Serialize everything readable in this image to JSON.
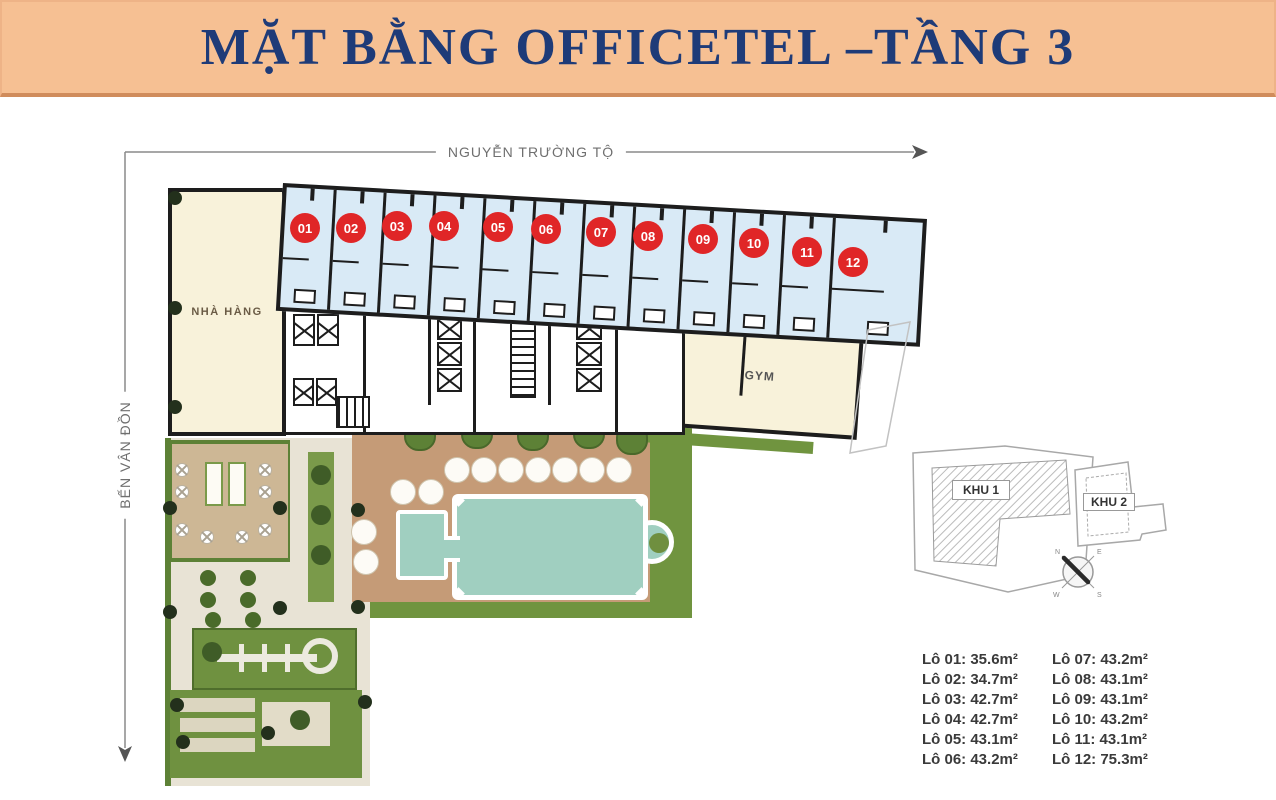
{
  "title": "MẶT BẰNG OFFICETEL –TẦNG 3",
  "streets": {
    "top": "NGUYỄN TRƯỜNG TỘ",
    "left": "BẾN VÂN ĐỒN"
  },
  "rooms": {
    "restaurant": "NHÀ HÀNG",
    "gym": "GYM"
  },
  "units": [
    {
      "label": "01",
      "area_m2": "35.6"
    },
    {
      "label": "02",
      "area_m2": "34.7"
    },
    {
      "label": "03",
      "area_m2": "42.7"
    },
    {
      "label": "04",
      "area_m2": "42.7"
    },
    {
      "label": "05",
      "area_m2": "43.1"
    },
    {
      "label": "06",
      "area_m2": "43.2"
    },
    {
      "label": "07",
      "area_m2": "43.2"
    },
    {
      "label": "08",
      "area_m2": "43.1"
    },
    {
      "label": "09",
      "area_m2": "43.1"
    },
    {
      "label": "10",
      "area_m2": "43.2"
    },
    {
      "label": "11",
      "area_m2": "43.1"
    },
    {
      "label": "12",
      "area_m2": "75.3"
    }
  ],
  "key_plan": {
    "zone1_label": "KHU 1",
    "zone2_label": "KHU 2"
  },
  "compass": {
    "points": [
      "N",
      "E",
      "S",
      "W"
    ]
  },
  "legend": {
    "left": [
      "Lô 01: 35.6m²",
      "Lô 02: 34.7m²",
      "Lô 03: 42.7m²",
      "Lô 04: 42.7m²",
      "Lô 05: 43.1m²",
      "Lô 06: 43.2m²"
    ],
    "right": [
      "Lô 07: 43.2m²",
      "Lô 08: 43.1m²",
      "Lô 09: 43.1m²",
      "Lô 10: 43.2m²",
      "Lô 11: 43.1m²",
      "Lô 12: 75.3m²"
    ]
  },
  "colors": {
    "banner_bg": "#f6c093",
    "banner_border": "#d08c5c",
    "title_text": "#1e3b78",
    "unit_fill": "#d9eaf6",
    "wall": "#1d1d1d",
    "room_cream": "#f8f2da",
    "unit_badge_red": "#e02627",
    "deck_tan": "#c59b77",
    "lawn_green": "#70943f",
    "pool_teal": "#a0cfc0",
    "stone": "#e8e3d5",
    "dimension_line": "#8a8a8a"
  }
}
